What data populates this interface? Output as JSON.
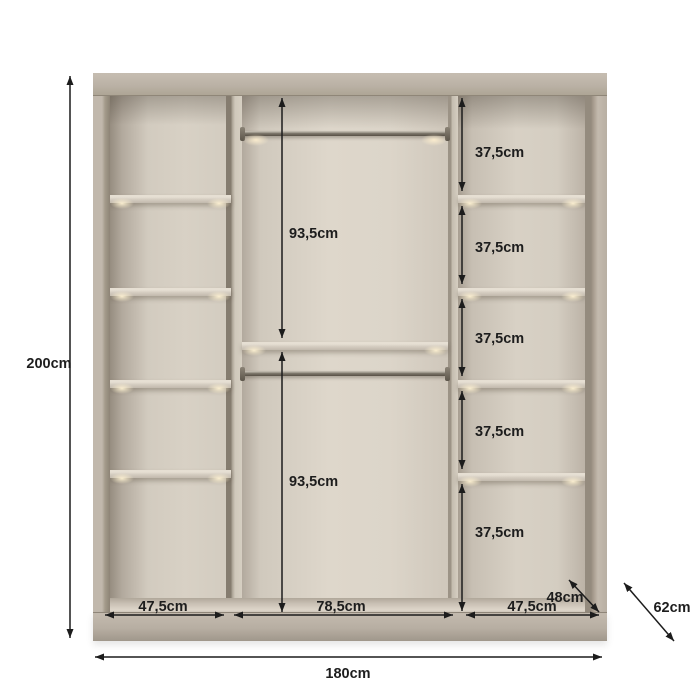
{
  "diagram": {
    "overall": {
      "height": "200cm",
      "width": "180cm",
      "depth": "62cm"
    },
    "sections": {
      "left_width": "47,5cm",
      "middle_width": "78,5cm",
      "right_width": "47,5cm"
    },
    "hanging": {
      "upper": "93,5cm",
      "lower": "93,5cm"
    },
    "shelf_spacings": [
      "37,5cm",
      "37,5cm",
      "37,5cm",
      "37,5cm",
      "37,5cm"
    ],
    "interior_depth": "48cm",
    "colors": {
      "background": "#ffffff",
      "body": "#b7aea2",
      "interior_light": "#d7d0c4",
      "annotation": "#1d1d1d"
    }
  }
}
